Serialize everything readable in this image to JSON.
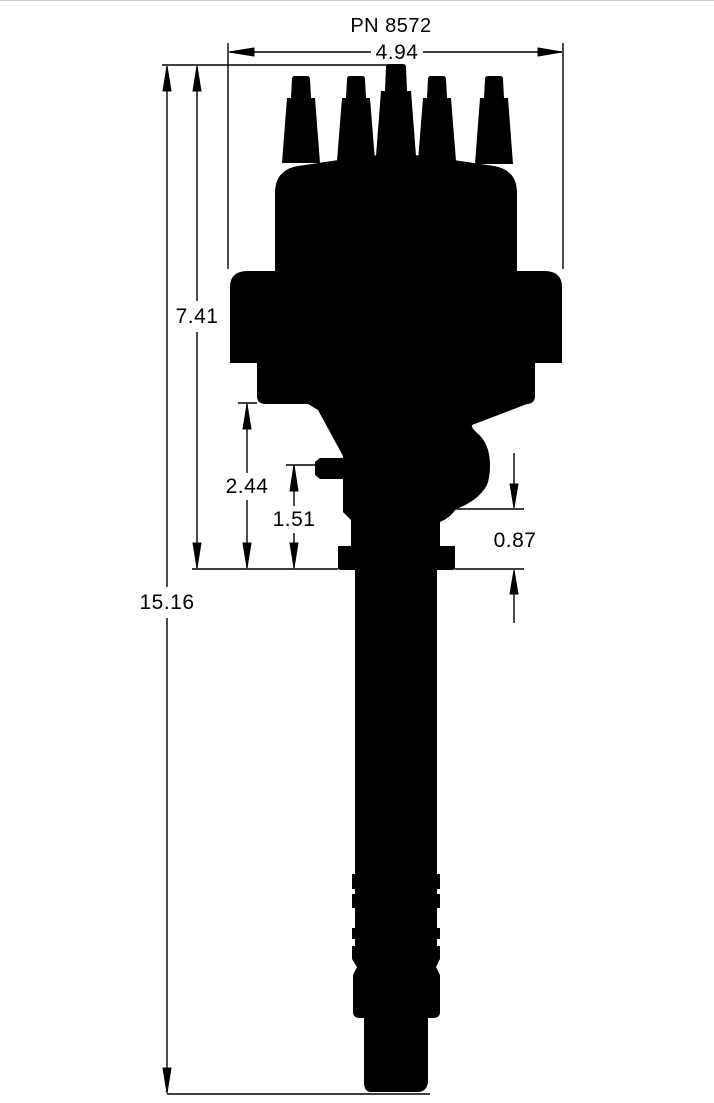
{
  "part_number": "PN 8572",
  "colors": {
    "ink": "#000000",
    "paper": "#ffffff"
  },
  "dimensions": {
    "cap_width": "4.94",
    "cap_to_base": "7.41",
    "housing_to_base": "2.44",
    "nipple_to_base": "1.51",
    "bulge_to_base": "0.87",
    "overall_height": "15.16"
  }
}
